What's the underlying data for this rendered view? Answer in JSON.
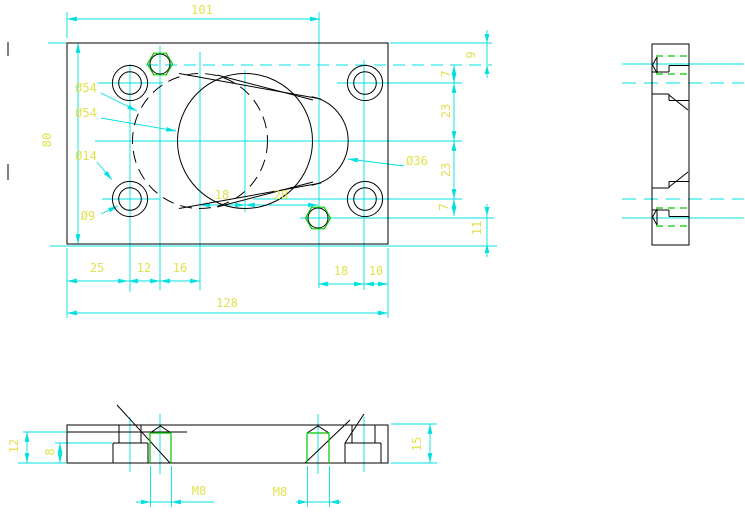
{
  "drawing": {
    "type": "mechanical-three-view-cad-drawing",
    "part": "rectangular cover plate with counterbored holes, M8 threaded holes, oval boss"
  },
  "colors": {
    "background": "#ffffff",
    "geometry": "#000000",
    "dimension_lines": "#00e0e0",
    "dimension_text": "#e2e24f",
    "thread_lines": "#00c800"
  },
  "front_view": {
    "dim_top_width": "101",
    "dim_left_height": "80",
    "dim_total_width": "128",
    "chain_bottom": {
      "d1": "25",
      "d2": "12",
      "d3": "16"
    },
    "chain_middle": {
      "d1": "18",
      "d2": "28"
    },
    "chain_bottom_right": {
      "d1": "18",
      "d2": "10"
    },
    "chain_right": {
      "d1": "7",
      "d2": "23",
      "d3": "23",
      "d4": "7"
    },
    "dim_right_top": "9",
    "dim_right_bottom": "11",
    "labels": {
      "counterbore_dia_1": "Ø54",
      "counterbore_dia_2": "Ø54",
      "hole_outer_dia": "Ø14",
      "hole_inner_dia": "Ø9",
      "boss_dia": "Ø36"
    }
  },
  "bottom_view": {
    "dim_thread_depth": "12",
    "dim_counterbore_depth": "8",
    "dim_thickness": "15",
    "thread_label_left": "M8",
    "thread_label_right": "M8"
  }
}
